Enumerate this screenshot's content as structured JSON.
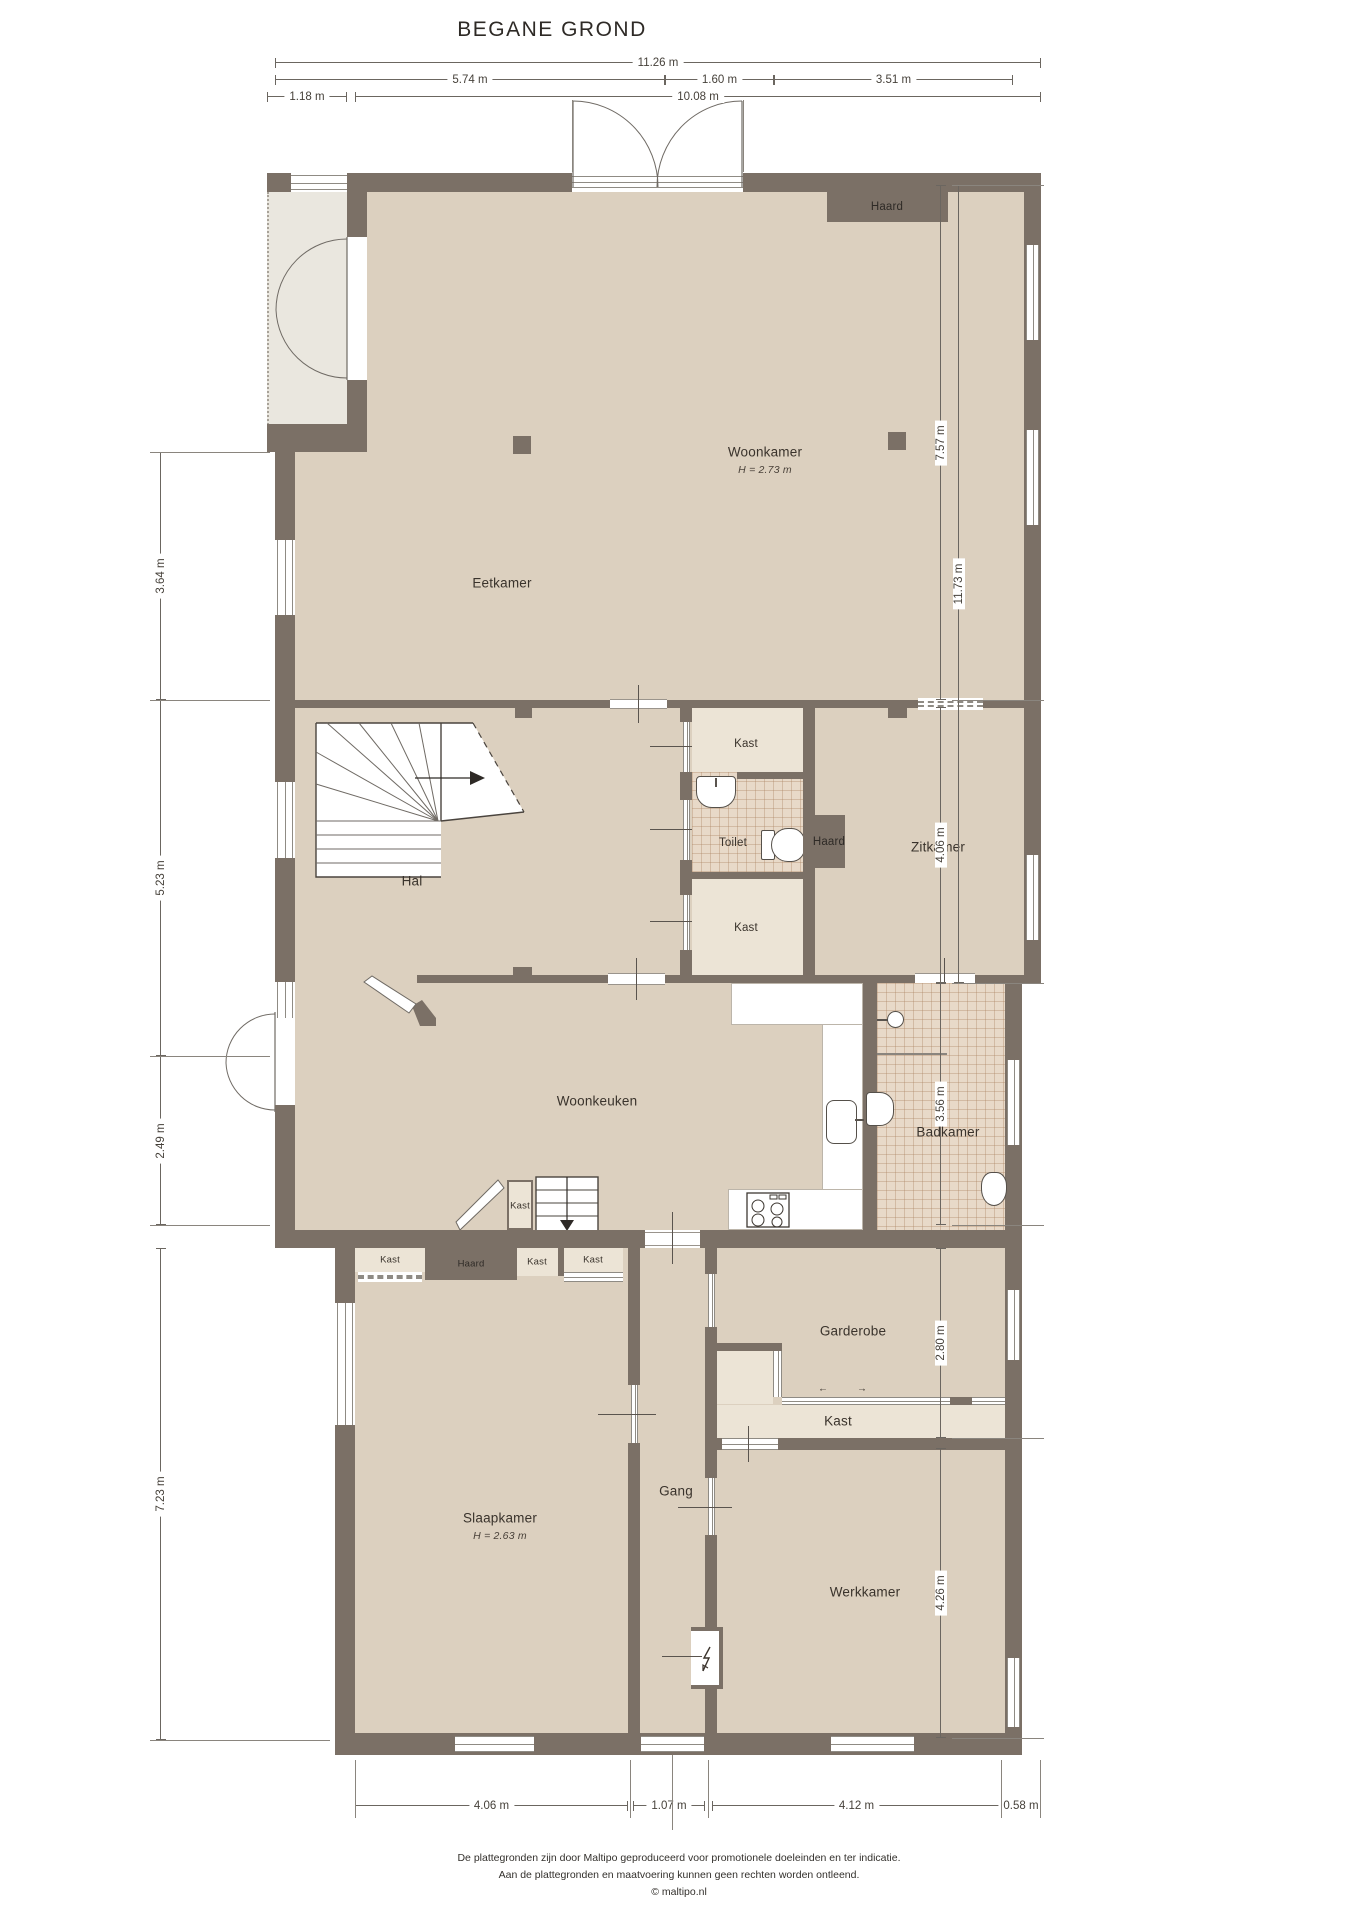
{
  "title": "BEGANE GROND",
  "rooms": {
    "woonkamer": {
      "label": "Woonkamer",
      "height": "H = 2.73 m"
    },
    "eetkamer": {
      "label": "Eetkamer"
    },
    "hal": {
      "label": "Hal"
    },
    "zitkamer": {
      "label": "Zitkamer"
    },
    "toilet": {
      "label": "Toilet"
    },
    "woonkeuken": {
      "label": "Woonkeuken"
    },
    "badkamer": {
      "label": "Badkamer"
    },
    "slaapkamer": {
      "label": "Slaapkamer",
      "height": "H = 2.63 m"
    },
    "gang": {
      "label": "Gang"
    },
    "garderobe": {
      "label": "Garderobe"
    },
    "werkkamer": {
      "label": "Werkkamer"
    }
  },
  "labels": {
    "kast": "Kast",
    "haard": "Haard",
    "slide_left_arrow": "←",
    "slide_right_arrow": "→"
  },
  "dimensions": {
    "top": [
      "11.26 m",
      "5.74 m",
      "1.60 m",
      "3.51 m",
      "1.18 m",
      "10.08 m"
    ],
    "left": [
      "3.64 m",
      "5.23 m",
      "2.49 m",
      "7.23 m"
    ],
    "right": [
      "7.57 m",
      "4.06 m",
      "3.56 m",
      "2.80 m",
      "4.26 m",
      "11.73 m"
    ],
    "bottom": [
      "4.06 m",
      "1.07 m",
      "4.12 m",
      "0.58 m"
    ]
  },
  "footer": {
    "line1": "De plattegronden zijn door Maltipo geproduceerd voor promotionele doeleinden en ter indicatie.",
    "line2": "Aan de plattegronden en maatvoering kunnen geen rechten worden ontleend.",
    "line3": "© maltipo.nl"
  },
  "colors": {
    "wall": "#7b7066",
    "floor": "#dcd0bf",
    "closet": "#ece4d6",
    "tile": "#e8d9c8",
    "porch": "#eae7df"
  }
}
